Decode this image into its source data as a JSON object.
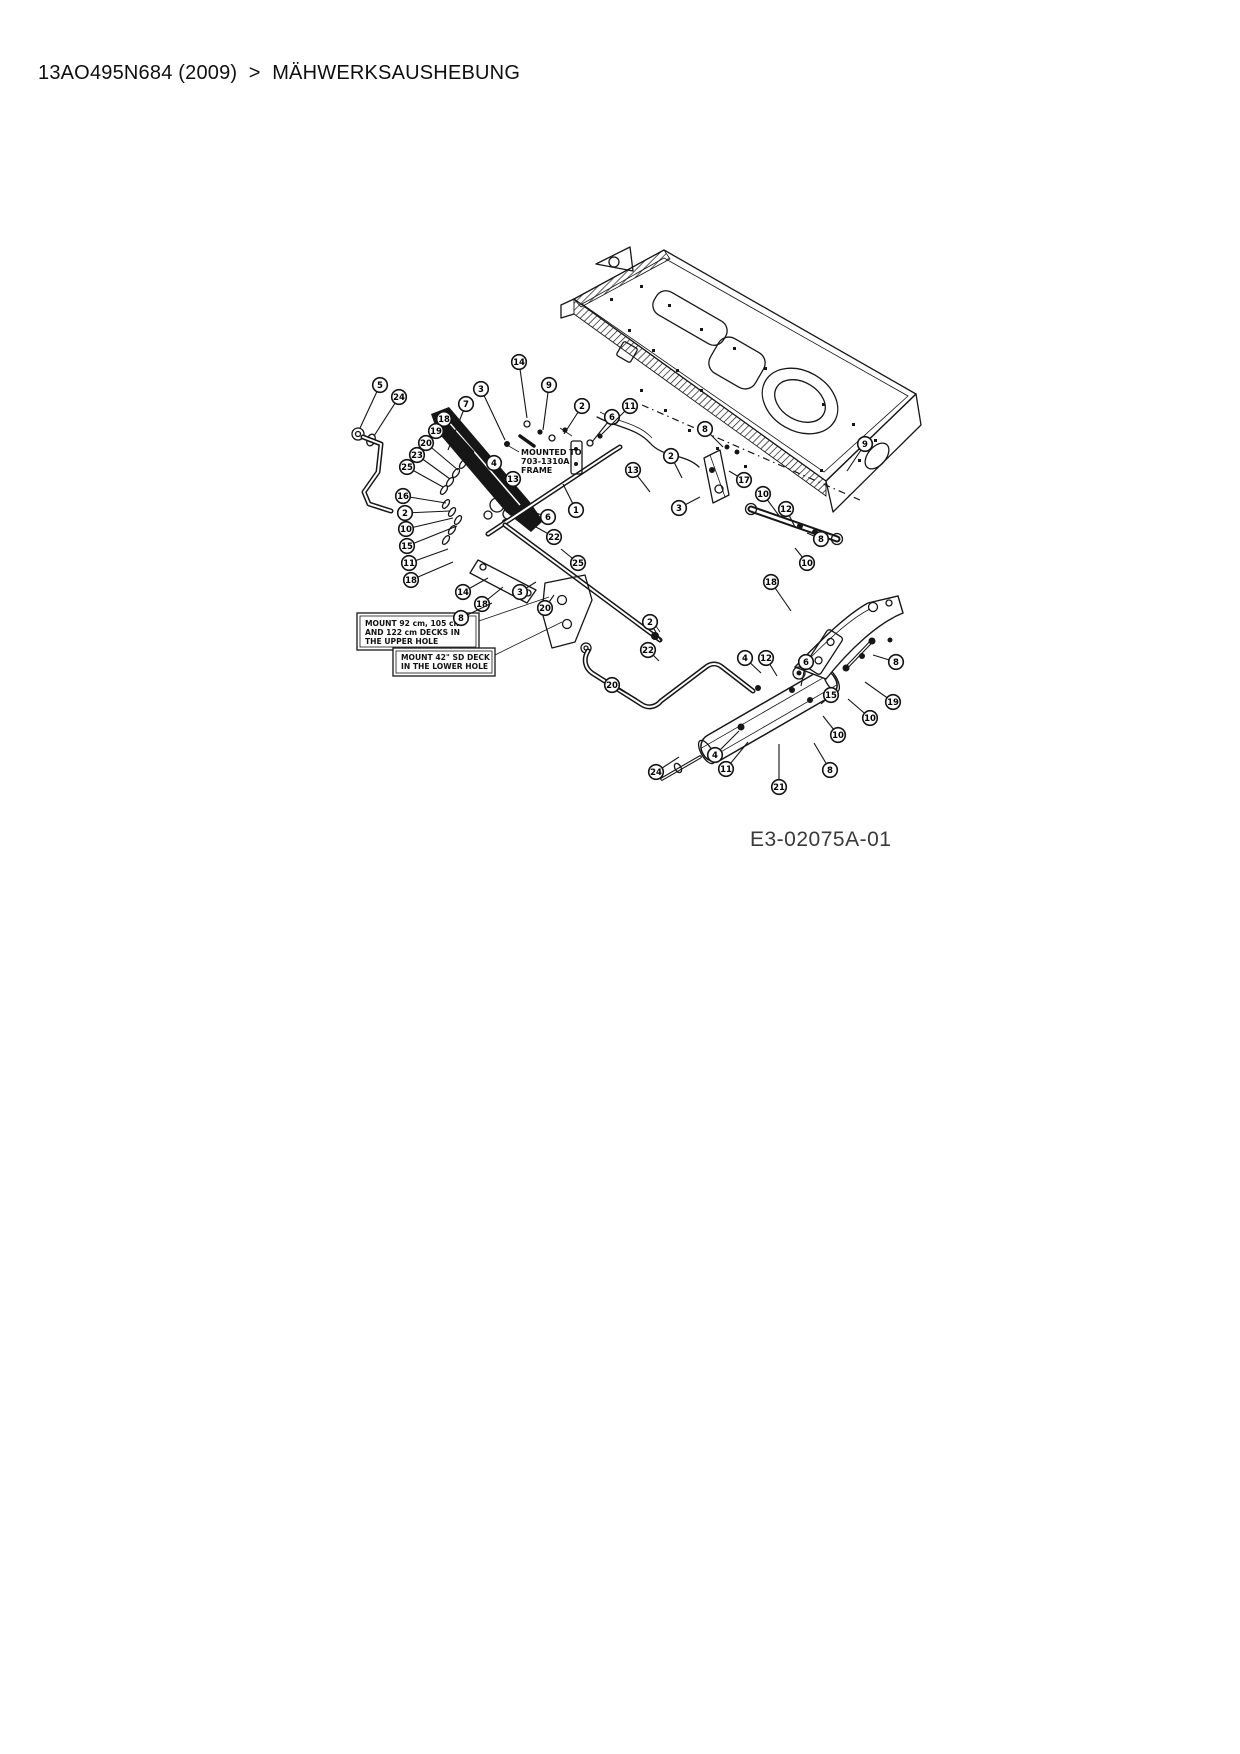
{
  "header": {
    "breadcrumb": "13AO495N684 (2009)  >  MÄHWERKSAUSHEBUNG"
  },
  "diagram": {
    "figure_code": "E3-02075A-01",
    "annotations": {
      "mounted_frame_note": [
        "MOUNTED TO",
        "703-1310A",
        "FRAME"
      ],
      "upper_hole_note": [
        "MOUNT 92 cm, 105 cm",
        "AND 122 cm DECKS IN",
        "THE UPPER HOLE"
      ],
      "lower_hole_note": [
        "MOUNT 42\" SD DECK",
        "IN THE LOWER HOLE"
      ]
    },
    "callouts": [
      {
        "n": "5",
        "x": 380,
        "y": 385,
        "lx": 360,
        "ly": 428
      },
      {
        "n": "24",
        "x": 399,
        "y": 397,
        "lx": 374,
        "ly": 436
      },
      {
        "n": "3",
        "x": 481,
        "y": 389,
        "lx": 505,
        "ly": 440
      },
      {
        "n": "7",
        "x": 466,
        "y": 404,
        "lx": 448,
        "ly": 450
      },
      {
        "n": "18",
        "x": 444,
        "y": 419,
        "lx": 474,
        "ly": 452
      },
      {
        "n": "19",
        "x": 436,
        "y": 431,
        "lx": 470,
        "ly": 461
      },
      {
        "n": "20",
        "x": 426,
        "y": 443,
        "lx": 458,
        "ly": 470
      },
      {
        "n": "23",
        "x": 417,
        "y": 455,
        "lx": 450,
        "ly": 479
      },
      {
        "n": "25",
        "x": 407,
        "y": 467,
        "lx": 443,
        "ly": 487
      },
      {
        "n": "16",
        "x": 403,
        "y": 496,
        "lx": 446,
        "ly": 503
      },
      {
        "n": "2",
        "x": 405,
        "y": 513,
        "lx": 450,
        "ly": 511
      },
      {
        "n": "10",
        "x": 406,
        "y": 529,
        "lx": 453,
        "ly": 518
      },
      {
        "n": "15",
        "x": 407,
        "y": 546,
        "lx": 457,
        "ly": 526
      },
      {
        "n": "11",
        "x": 409,
        "y": 563,
        "lx": 448,
        "ly": 549
      },
      {
        "n": "18",
        "x": 411,
        "y": 580,
        "lx": 453,
        "ly": 562
      },
      {
        "n": "14",
        "x": 519,
        "y": 362,
        "lx": 527,
        "ly": 418
      },
      {
        "n": "9",
        "x": 549,
        "y": 385,
        "lx": 543,
        "ly": 430
      },
      {
        "n": "2",
        "x": 582,
        "y": 406,
        "lx": 564,
        "ly": 434
      },
      {
        "n": "6",
        "x": 612,
        "y": 417,
        "lx": 592,
        "ly": 442
      },
      {
        "n": "11",
        "x": 630,
        "y": 406,
        "lx": 602,
        "ly": 434
      },
      {
        "n": "4",
        "x": 494,
        "y": 463,
        "lx": 508,
        "ly": 488
      },
      {
        "n": "13",
        "x": 513,
        "y": 479,
        "lx": 521,
        "ly": 503
      },
      {
        "n": "6",
        "x": 548,
        "y": 517,
        "lx": 533,
        "ly": 512
      },
      {
        "n": "1",
        "x": 576,
        "y": 510,
        "lx": 563,
        "ly": 484
      },
      {
        "n": "22",
        "x": 554,
        "y": 537,
        "lx": 536,
        "ly": 527
      },
      {
        "n": "25",
        "x": 578,
        "y": 563,
        "lx": 561,
        "ly": 549
      },
      {
        "n": "13",
        "x": 633,
        "y": 470,
        "lx": 650,
        "ly": 492
      },
      {
        "n": "2",
        "x": 671,
        "y": 456,
        "lx": 682,
        "ly": 478
      },
      {
        "n": "8",
        "x": 705,
        "y": 429,
        "lx": 723,
        "ly": 447
      },
      {
        "n": "17",
        "x": 744,
        "y": 480,
        "lx": 729,
        "ly": 471
      },
      {
        "n": "3",
        "x": 679,
        "y": 508,
        "lx": 700,
        "ly": 497
      },
      {
        "n": "9",
        "x": 865,
        "y": 444,
        "lx": 847,
        "ly": 471
      },
      {
        "n": "10",
        "x": 763,
        "y": 494,
        "lx": 780,
        "ly": 517
      },
      {
        "n": "12",
        "x": 786,
        "y": 509,
        "lx": 795,
        "ly": 527
      },
      {
        "n": "8",
        "x": 821,
        "y": 539,
        "lx": 807,
        "ly": 533
      },
      {
        "n": "10",
        "x": 807,
        "y": 563,
        "lx": 795,
        "ly": 548
      },
      {
        "n": "14",
        "x": 463,
        "y": 592,
        "lx": 488,
        "ly": 578
      },
      {
        "n": "18",
        "x": 482,
        "y": 604,
        "lx": 503,
        "ly": 587
      },
      {
        "n": "8",
        "x": 461,
        "y": 618,
        "lx": 492,
        "ly": 603
      },
      {
        "n": "3",
        "x": 520,
        "y": 592,
        "lx": 536,
        "ly": 582
      },
      {
        "n": "20",
        "x": 545,
        "y": 608,
        "lx": 554,
        "ly": 595
      },
      {
        "n": "2",
        "x": 650,
        "y": 622,
        "lx": 661,
        "ly": 641
      },
      {
        "n": "22",
        "x": 648,
        "y": 650,
        "lx": 659,
        "ly": 661
      },
      {
        "n": "20",
        "x": 612,
        "y": 685,
        "lx": 637,
        "ly": 699
      },
      {
        "n": "24",
        "x": 656,
        "y": 772,
        "lx": 679,
        "ly": 757
      },
      {
        "n": "18",
        "x": 771,
        "y": 582,
        "lx": 791,
        "ly": 611
      },
      {
        "n": "4",
        "x": 745,
        "y": 658,
        "lx": 761,
        "ly": 673
      },
      {
        "n": "12",
        "x": 766,
        "y": 658,
        "lx": 777,
        "ly": 676
      },
      {
        "n": "6",
        "x": 806,
        "y": 662,
        "lx": 801,
        "ly": 686
      },
      {
        "n": "15",
        "x": 831,
        "y": 695,
        "lx": 821,
        "ly": 704
      },
      {
        "n": "8",
        "x": 896,
        "y": 662,
        "lx": 873,
        "ly": 655
      },
      {
        "n": "19",
        "x": 893,
        "y": 702,
        "lx": 865,
        "ly": 682
      },
      {
        "n": "10",
        "x": 870,
        "y": 718,
        "lx": 848,
        "ly": 699
      },
      {
        "n": "10",
        "x": 838,
        "y": 735,
        "lx": 823,
        "ly": 716
      },
      {
        "n": "8",
        "x": 830,
        "y": 770,
        "lx": 814,
        "ly": 743
      },
      {
        "n": "4",
        "x": 715,
        "y": 755,
        "lx": 739,
        "ly": 731
      },
      {
        "n": "11",
        "x": 726,
        "y": 769,
        "lx": 748,
        "ly": 742
      },
      {
        "n": "21",
        "x": 779,
        "y": 787,
        "lx": 779,
        "ly": 744
      }
    ]
  }
}
